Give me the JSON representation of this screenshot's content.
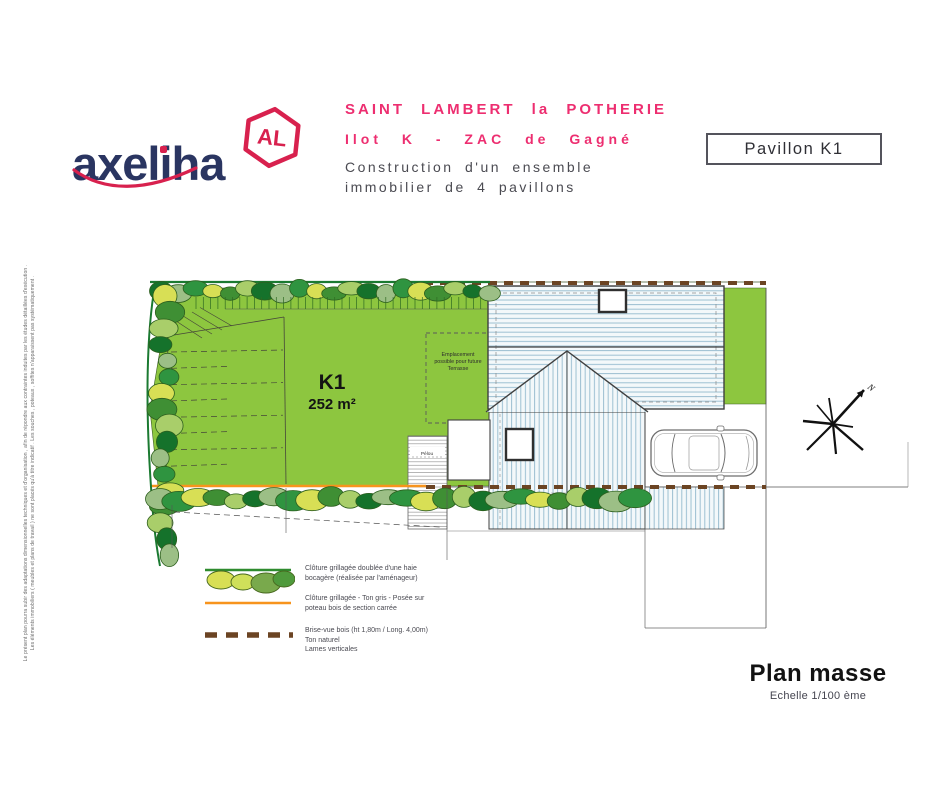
{
  "side_note": {
    "line1": "Le présent plan pourra subir des adaptations dimensionnelles techniques et d'organisation , afin de répondre aux contraintes induites par les études détaillées d'exécution .",
    "line2": "Les éléments immobiliers ( meubles et plans de travail ) ne sont placés qu'à titre indicatif . Les souches , poteaux , soffites n'apparaissent pas systématiquement ."
  },
  "header": {
    "logo_text": "axeliha",
    "logo_badge": "AL",
    "project_location": "SAINT LAMBERT la POTHERIE",
    "project_lot": "Ilot K - ZAC de Gagné",
    "project_desc_line1": "Construction d'un ensemble",
    "project_desc_line2": "immobilier de 4 pavillons",
    "pavilion_box": "Pavillon K1"
  },
  "plan": {
    "parcel_label": "K1",
    "parcel_area": "252 m²",
    "terrace_line1": "Emplacement",
    "terrace_line2": "possible pour future",
    "terrace_line3": "Terrasse",
    "strip_label": "Pélou",
    "compass_label": "N"
  },
  "legend": {
    "items": [
      {
        "line1": "Clôture grillagée doublée d'une haie",
        "line2": "bocagère (réalisée par l'aménageur)",
        "line3": ""
      },
      {
        "line1": "Clôture grillagée - Ton gris - Posée sur",
        "line2": "poteau bois de section carrée",
        "line3": ""
      },
      {
        "line1": "Brise-vue bois (ht 1,80m / Long. 4,00m)",
        "line2": "Ton naturel",
        "line3": "Lames verticales"
      }
    ]
  },
  "footer": {
    "title": "Plan masse",
    "scale": "Echelle 1/100 ème"
  },
  "colors": {
    "accent_pink": "#ED2E70",
    "logo_navy": "#2A3561",
    "logo_red": "#D8214E",
    "lawn_green": "#8DC63F",
    "fence_orange": "#F7941D",
    "screen_brown": "#6B4423",
    "hedge_green": "#1B7A31"
  }
}
